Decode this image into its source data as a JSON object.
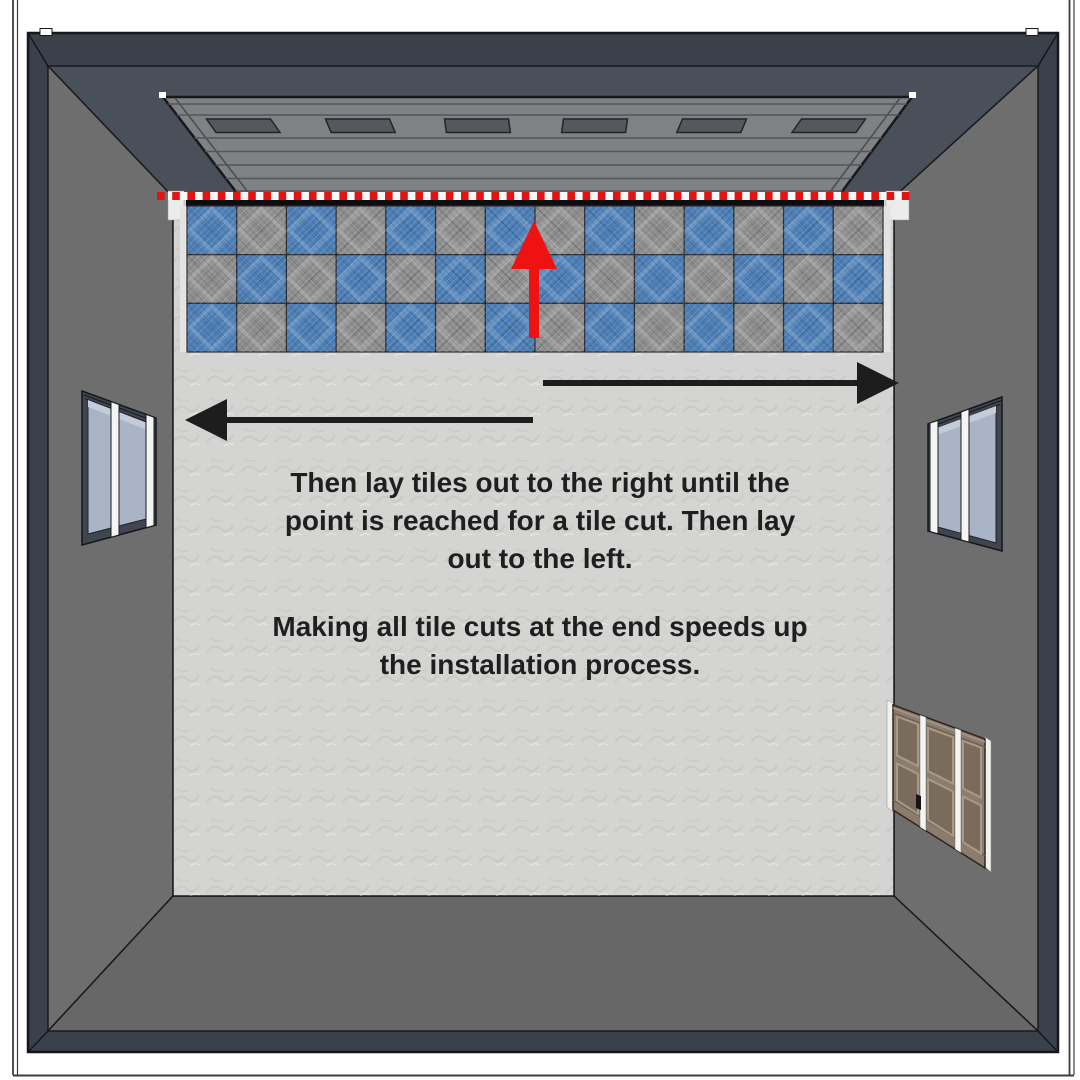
{
  "scene": {
    "instructions": {
      "p1_lines": [
        "Then lay tiles out to the right until the",
        "point is reached for a tile cut. Then lay",
        "out to the left."
      ],
      "p2_lines": [
        "Making all tile cuts at the end speeds up",
        "the installation process."
      ]
    },
    "tile_grid": {
      "rows": 3,
      "cols": 14,
      "checker_start": "blue"
    },
    "garage_door": {
      "window_count": 6
    },
    "colors": {
      "frame": "#3a414b",
      "ceiling": "#49505a",
      "wall": "#6e6e6e",
      "wall_bottom": "#676767",
      "floor": "#d4d4d2",
      "garage_door": "#7f8184",
      "door_window": "#55585c",
      "tile_blue": "#4e80b8",
      "tile_gray": "#8f8f8f",
      "dash_red": "#e21313",
      "dash_white": "#f7f7f7",
      "black_strip": "#0d0d0d",
      "arrow_red": "#ee1212",
      "arrow_black": "#1d1d1d",
      "side_door_brown": "#8b7c6c",
      "side_door_panel": "#7a6b5c",
      "window_glass": "#a9b4c7",
      "mullion_white": "#f4f4f2",
      "text": "#1f1f1f"
    }
  }
}
